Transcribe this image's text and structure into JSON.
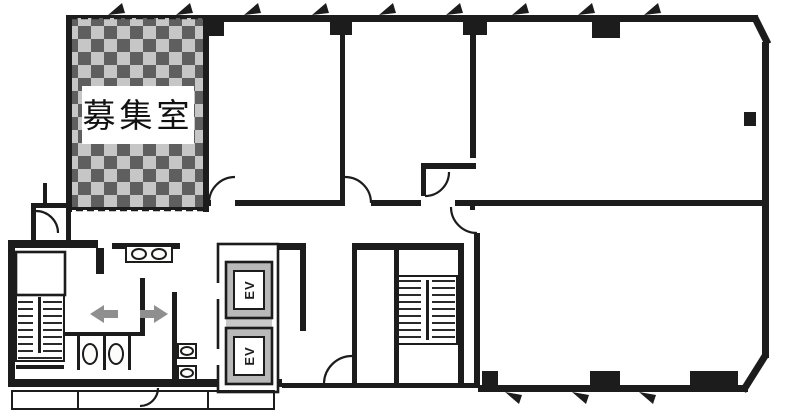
{
  "page": {
    "background": "#ffffff",
    "kind": "building-floor-plan"
  },
  "plan": {
    "vacant_room": {
      "label": "募集室",
      "pattern": "checkerboard"
    },
    "elevators": [
      {
        "label": "EV"
      },
      {
        "label": "EV"
      }
    ],
    "features": {
      "stairwells": 2,
      "entry_arrows": [
        "left",
        "right"
      ],
      "window_ticks_top": 9,
      "window_ticks_bottom": 3
    },
    "colors": {
      "paper": "#ffffff",
      "wall": "#1c1c1c",
      "checker-dark": "#5f5f5f",
      "checker-light": "#c6c6c6",
      "checker-bg": "#efefec",
      "arrow": "#8f8f8f",
      "ev-fill": "#b9b9b9"
    }
  }
}
